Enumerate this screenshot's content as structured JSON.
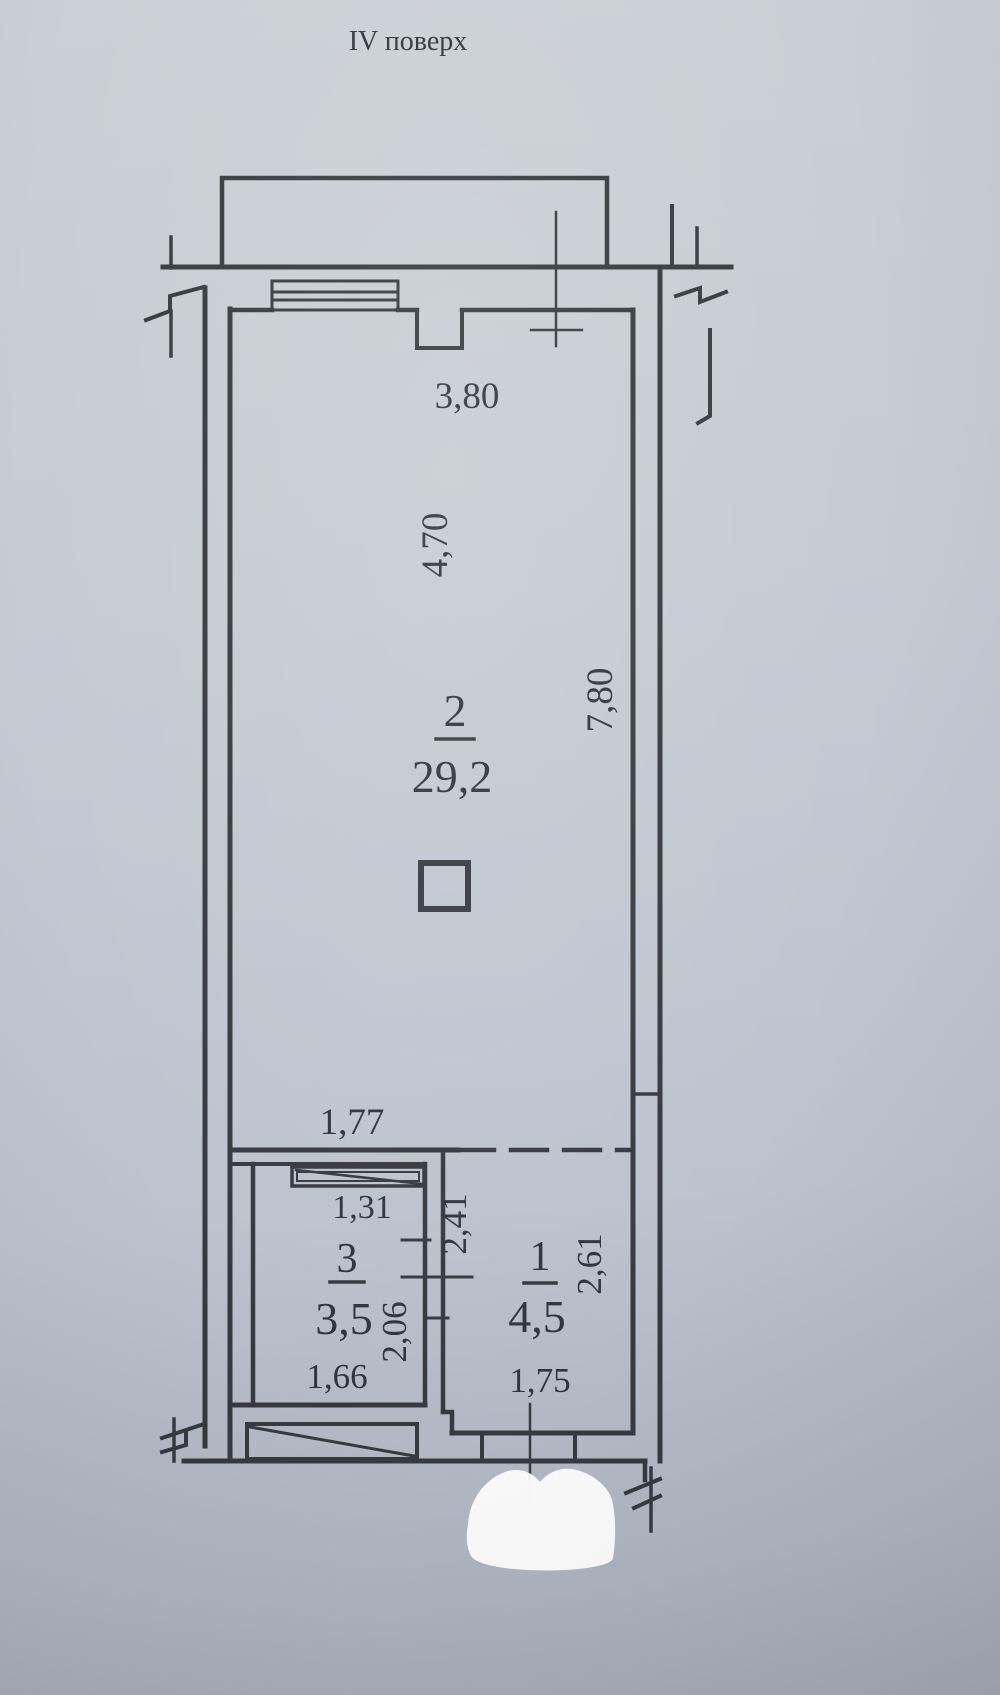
{
  "title": "IV поверх",
  "colors": {
    "paper": "#c5cad3",
    "ink": "#2d3036"
  },
  "rooms": [
    {
      "number": "2",
      "area": "29,2"
    },
    {
      "number": "3",
      "area": "3,5"
    },
    {
      "number": "1",
      "area": "4,5"
    }
  ],
  "dimensions": {
    "window_top": "3,80",
    "room2_width": "4,70",
    "room2_length": "7,80",
    "opening_room2": "1,77",
    "room3_window": "1,31",
    "hall_length": "2,41",
    "room3_length": "2,06",
    "room3_width": "1,66",
    "room1_length": "2,61",
    "room1_width": "1,75"
  }
}
